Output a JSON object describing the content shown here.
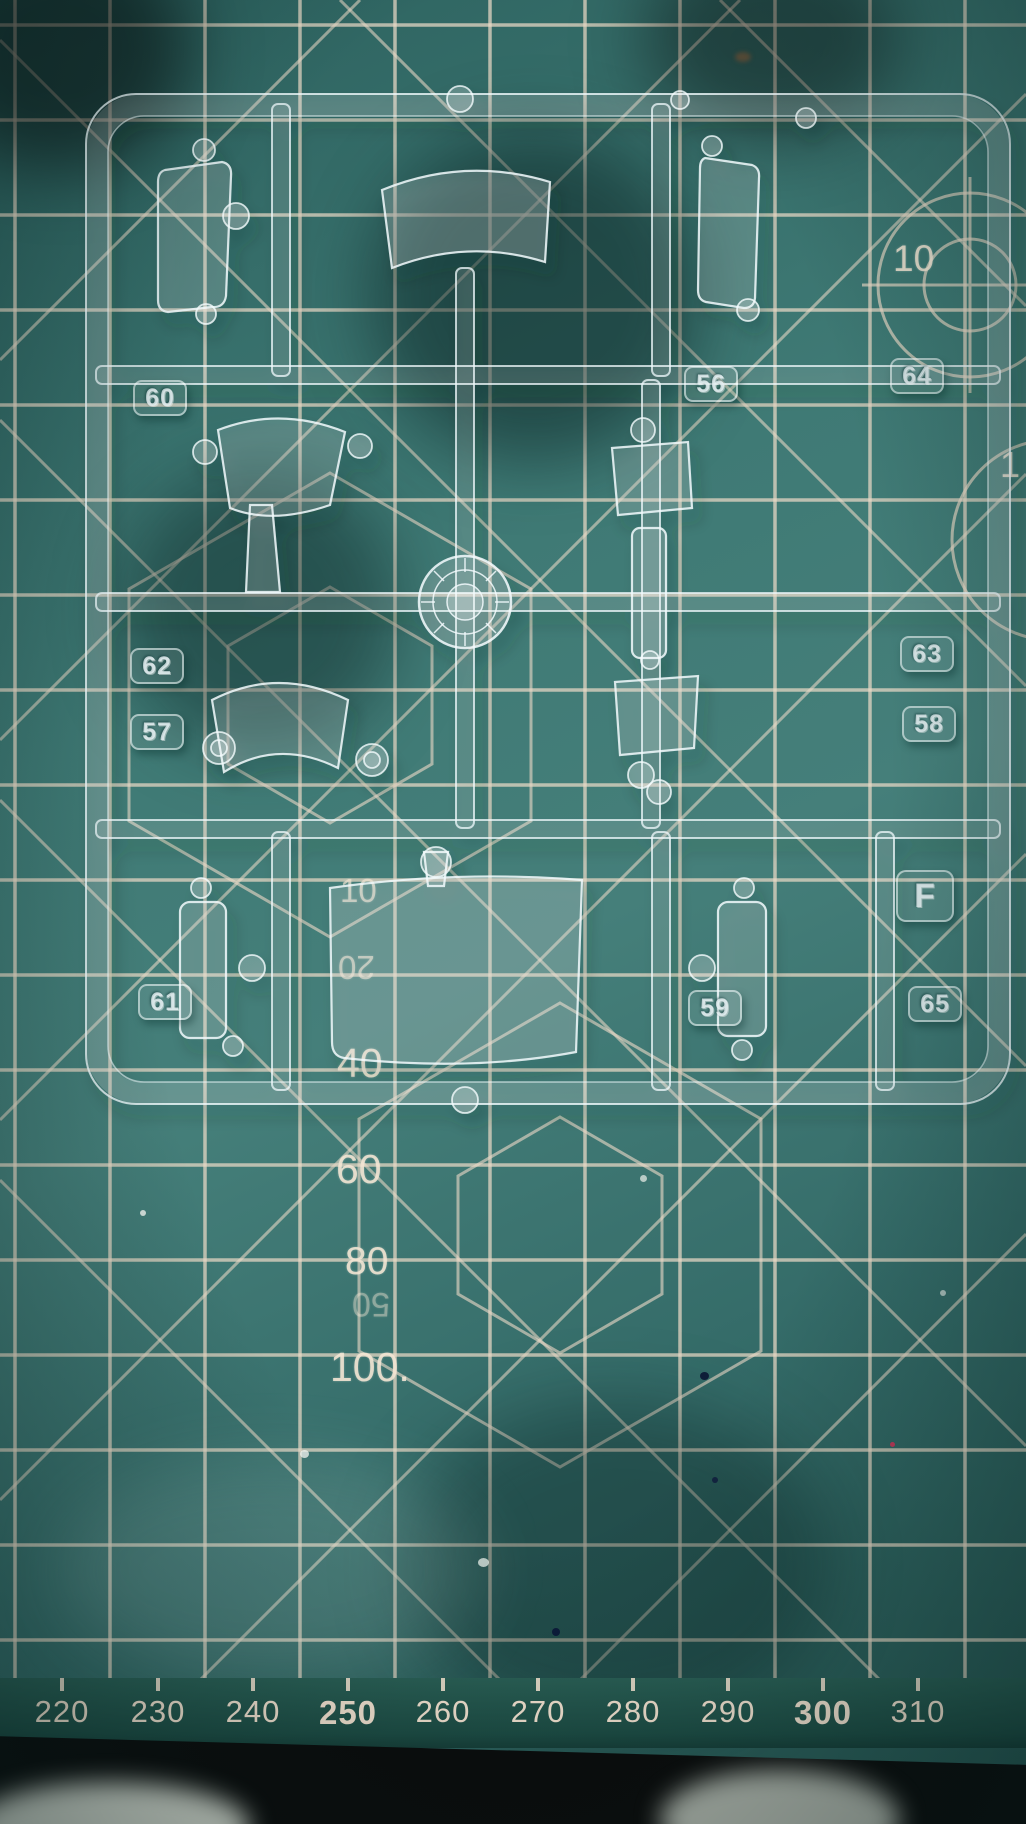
{
  "sprue": {
    "tags": [
      {
        "label": "60"
      },
      {
        "label": "56"
      },
      {
        "label": "64"
      },
      {
        "label": "62"
      },
      {
        "label": "57"
      },
      {
        "label": "63"
      },
      {
        "label": "58"
      },
      {
        "label": "F"
      },
      {
        "label": "61"
      },
      {
        "label": "59"
      },
      {
        "label": "65"
      }
    ]
  },
  "mat": {
    "scale_labels": [
      {
        "text": "10"
      },
      {
        "text": "1"
      },
      {
        "text": "10"
      },
      {
        "text": "20"
      },
      {
        "text": "40"
      },
      {
        "text": "60"
      },
      {
        "text": "80"
      },
      {
        "text": "50"
      },
      {
        "text": "100."
      }
    ],
    "ruler_labels": [
      {
        "text": "220",
        "bold": false
      },
      {
        "text": "230",
        "bold": false
      },
      {
        "text": "240",
        "bold": false
      },
      {
        "text": "250",
        "bold": true
      },
      {
        "text": "260",
        "bold": false
      },
      {
        "text": "270",
        "bold": false
      },
      {
        "text": "280",
        "bold": false
      },
      {
        "text": "290",
        "bold": false
      },
      {
        "text": "300",
        "bold": true
      },
      {
        "text": "310",
        "bold": false
      }
    ],
    "colors": {
      "mat_surface": "#3f7a75",
      "grid_line": "#ead9c6",
      "ruler_text": "#f6e4d2",
      "plastic": "#ffffff",
      "shadow": "#0b0b0b"
    }
  }
}
